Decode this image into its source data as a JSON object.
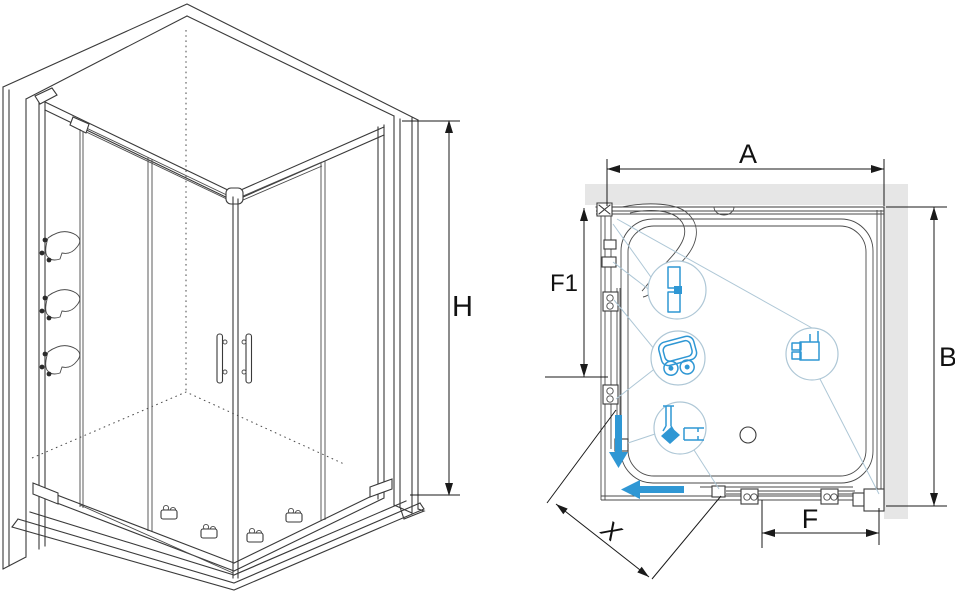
{
  "document": {
    "type": "technical-installation-diagram",
    "subject": "Corner shower enclosure with two sliding doors, isometric view and plan view"
  },
  "colors": {
    "accent_blue": "#2F97D4",
    "wall_fill": "#E6E6E6",
    "line_dark": "#3A3A3A",
    "callout_line": "#AEC7D6",
    "background": "#FFFFFF"
  },
  "isometric_view": {
    "description": "3D wireframe of corner shower enclosure on tray between two walls",
    "dimension_labels": {
      "height": "H"
    }
  },
  "plan_view": {
    "description": "Top-down plan of square shower tray with walls at top and right",
    "dimension_labels": {
      "width": "A",
      "depth": "B",
      "front_door": "F",
      "side_panel": "F1",
      "diagonal_entry": "X"
    },
    "callouts": [
      {
        "icon": "wall-profile-icon"
      },
      {
        "icon": "roller-carriage-icon"
      },
      {
        "icon": "magnetic-seal-icon"
      },
      {
        "icon": "corner-joint-icon"
      }
    ],
    "slide_direction_arrows": [
      "down",
      "left"
    ]
  }
}
